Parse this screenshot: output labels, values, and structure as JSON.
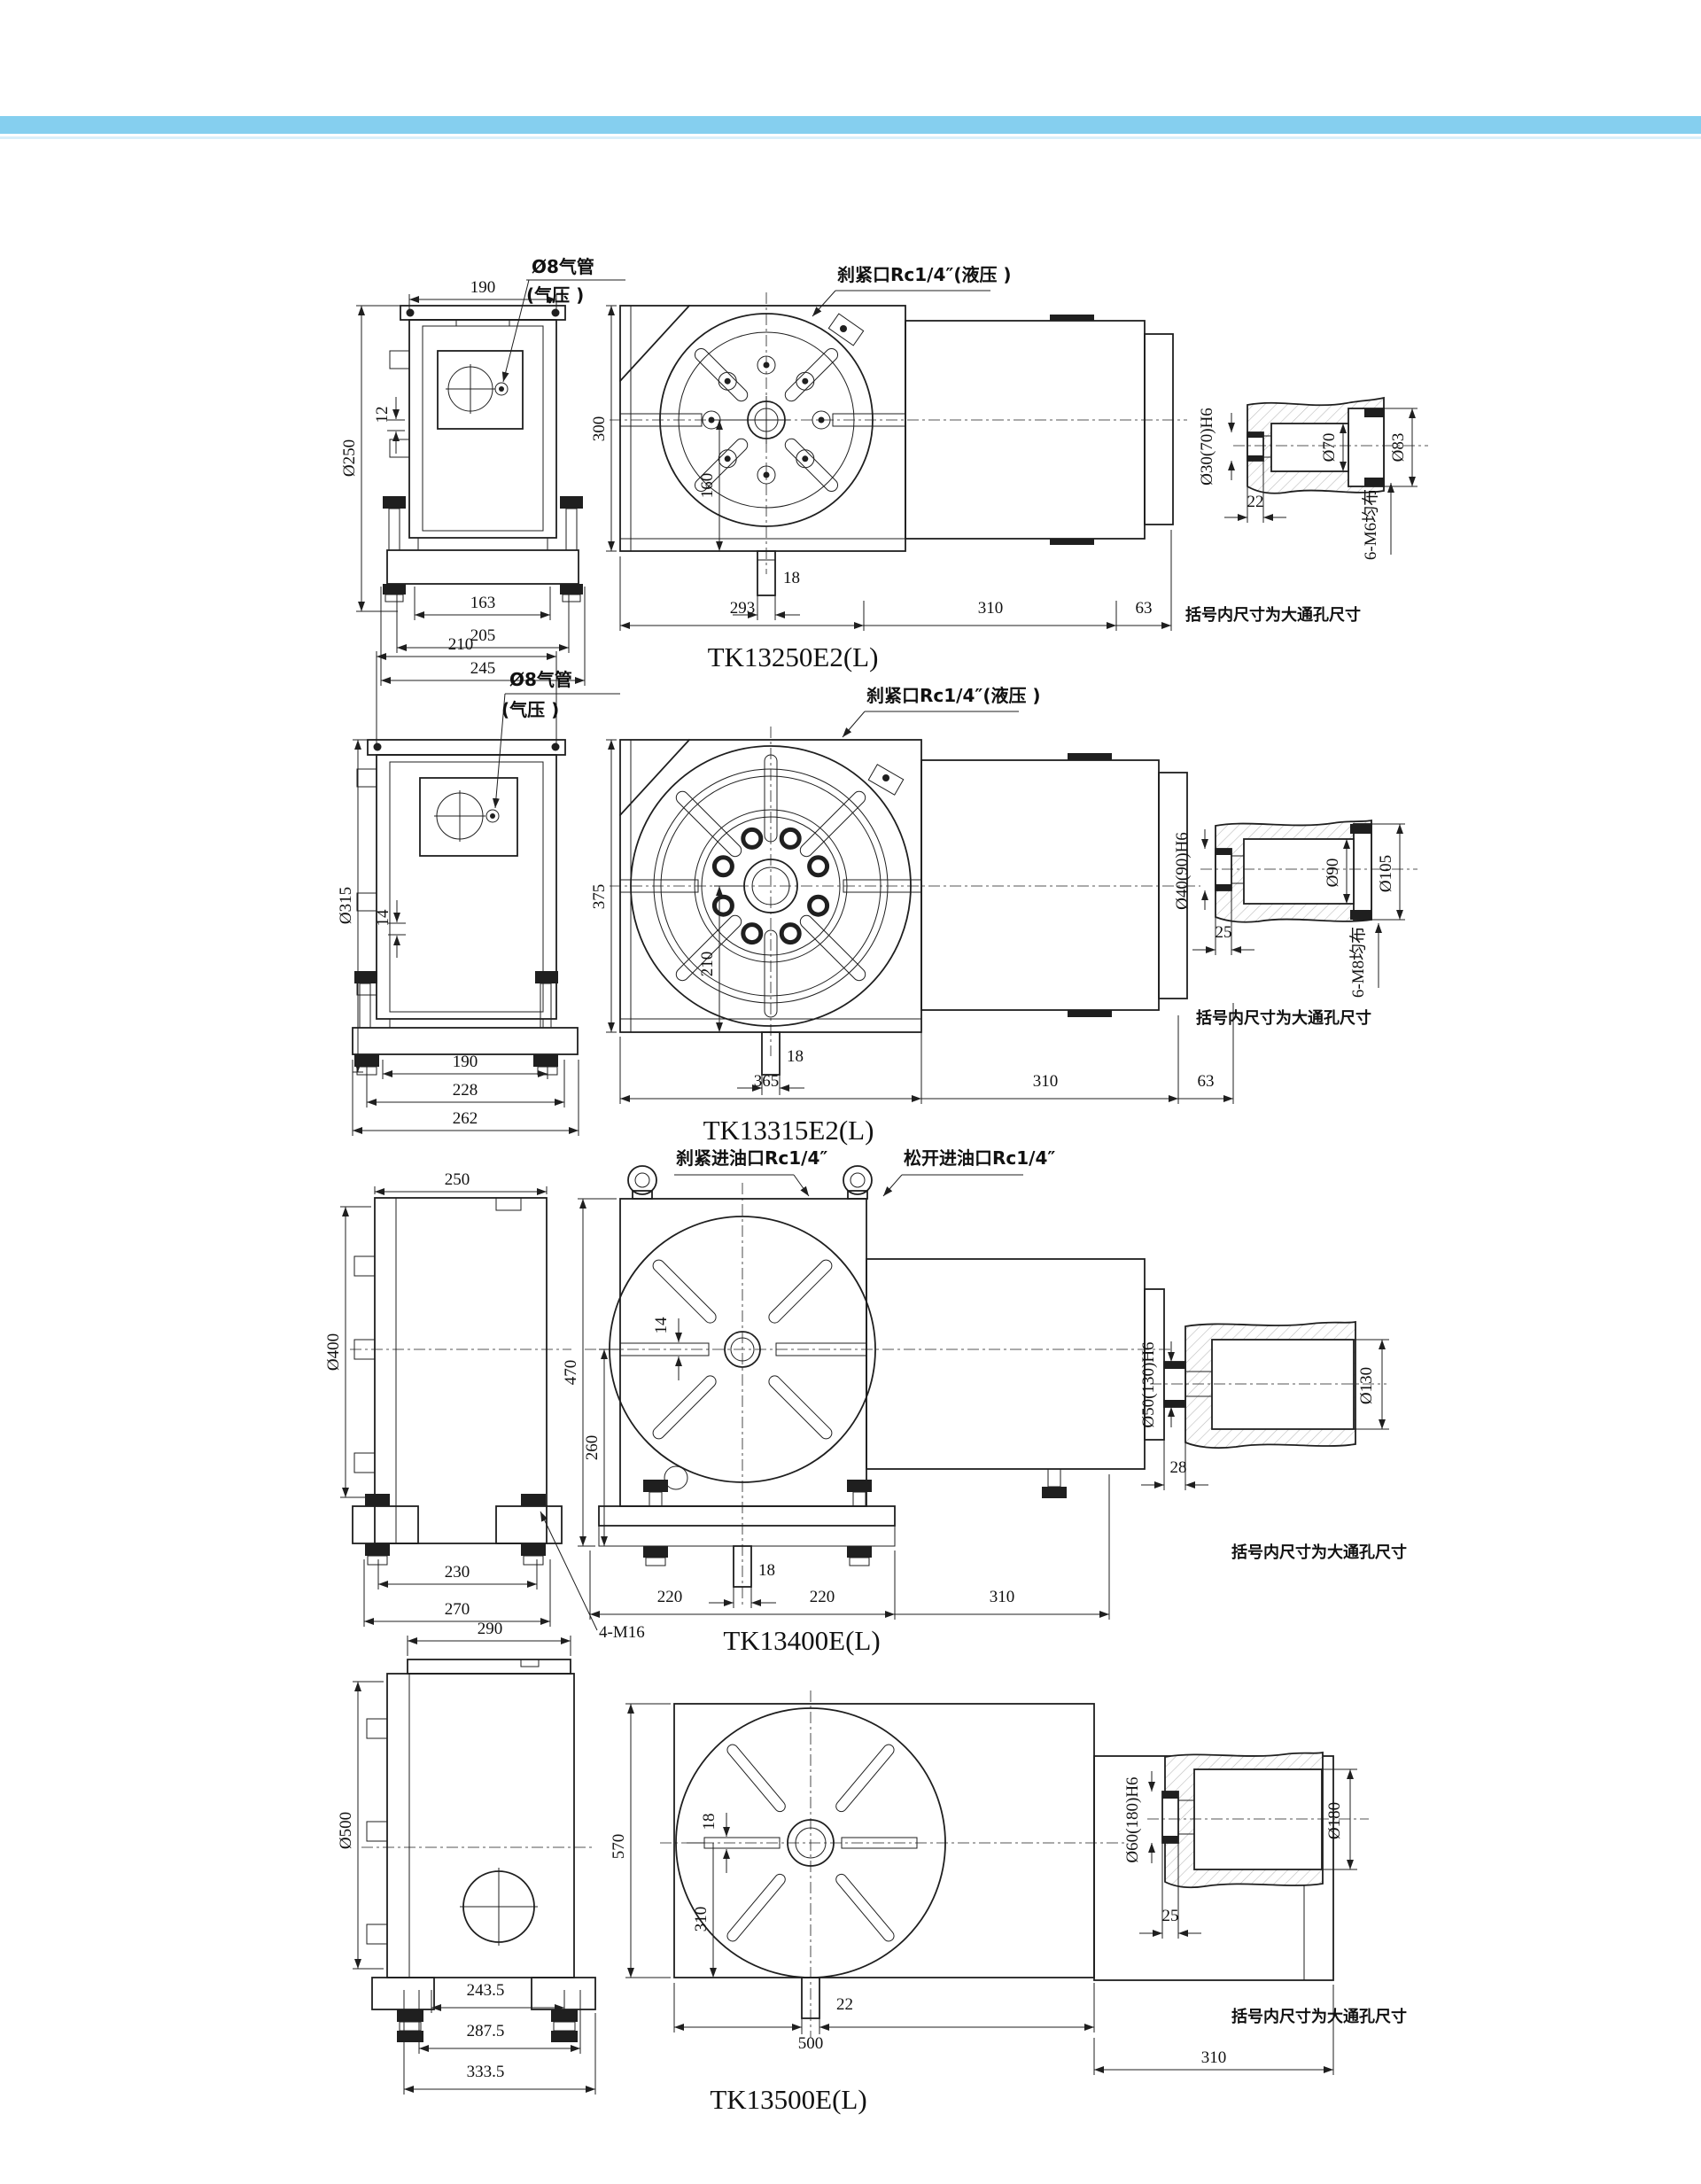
{
  "page": {
    "band_color": "#85CFEF",
    "band_underline_color": "#D9EFFA"
  },
  "note": "括号内尺寸为大通孔尺寸",
  "rows": [
    {
      "model": "TK13250E2(L)",
      "callout_air": "Ø8气管",
      "callout_air2": "(气压 )",
      "callout_clamp": "刹紧口Rc1/4″(液压 )",
      "side": {
        "top": "190",
        "dia": "Ø250",
        "offset": "12",
        "d1": "163",
        "d2": "205",
        "d3": "245"
      },
      "front": {
        "h": "300",
        "ch": "160",
        "slot": "18",
        "w1": "293",
        "w2": "310",
        "w3": "63"
      },
      "detail": {
        "bore": "Ø30(70)H6",
        "len": "22",
        "d_in": "Ø70",
        "d_out": "Ø83",
        "bolts": "6-M6均布"
      }
    },
    {
      "model": "TK13315E2(L)",
      "callout_air": "Ø8气管",
      "callout_air2": "(气压 )",
      "callout_clamp": "刹紧口Rc1/4″(液压 )",
      "side": {
        "top": "210",
        "dia": "Ø315",
        "offset": "14",
        "d1": "190",
        "d2": "228",
        "d3": "262"
      },
      "front": {
        "h": "375",
        "ch": "210",
        "slot": "18",
        "w1": "365",
        "w2": "310",
        "w3": "63"
      },
      "detail": {
        "bore": "Ø40(90)H6",
        "len": "25",
        "d_in": "Ø90",
        "d_out": "Ø105",
        "bolts": "6-M8均布"
      }
    },
    {
      "model": "TK13400E(L)",
      "callout_clamp_oil": "刹紧进油口Rc1/4″",
      "callout_release_oil": "松开进油口Rc1/4″",
      "bolt_callout": "4-M16",
      "side": {
        "top": "250",
        "dia": "Ø400",
        "d1": "230",
        "d2": "270"
      },
      "front": {
        "h": "470",
        "ch": "260",
        "slot": "14",
        "stub": "18",
        "w1": "220",
        "w2": "220",
        "w3": "310"
      },
      "detail": {
        "bore": "Ø50(130)H6",
        "len": "28",
        "d_out": "Ø130"
      }
    },
    {
      "model": "TK13500E(L)",
      "side": {
        "top": "290",
        "dia": "Ø500",
        "d1": "243.5",
        "d2": "287.5",
        "d3": "333.5"
      },
      "front": {
        "h": "570",
        "ch": "310",
        "slot": "18",
        "stub": "22",
        "w1": "500",
        "w2": "310"
      },
      "detail": {
        "bore": "Ø60(180)H6",
        "len": "25",
        "d_out": "Ø180"
      }
    }
  ]
}
